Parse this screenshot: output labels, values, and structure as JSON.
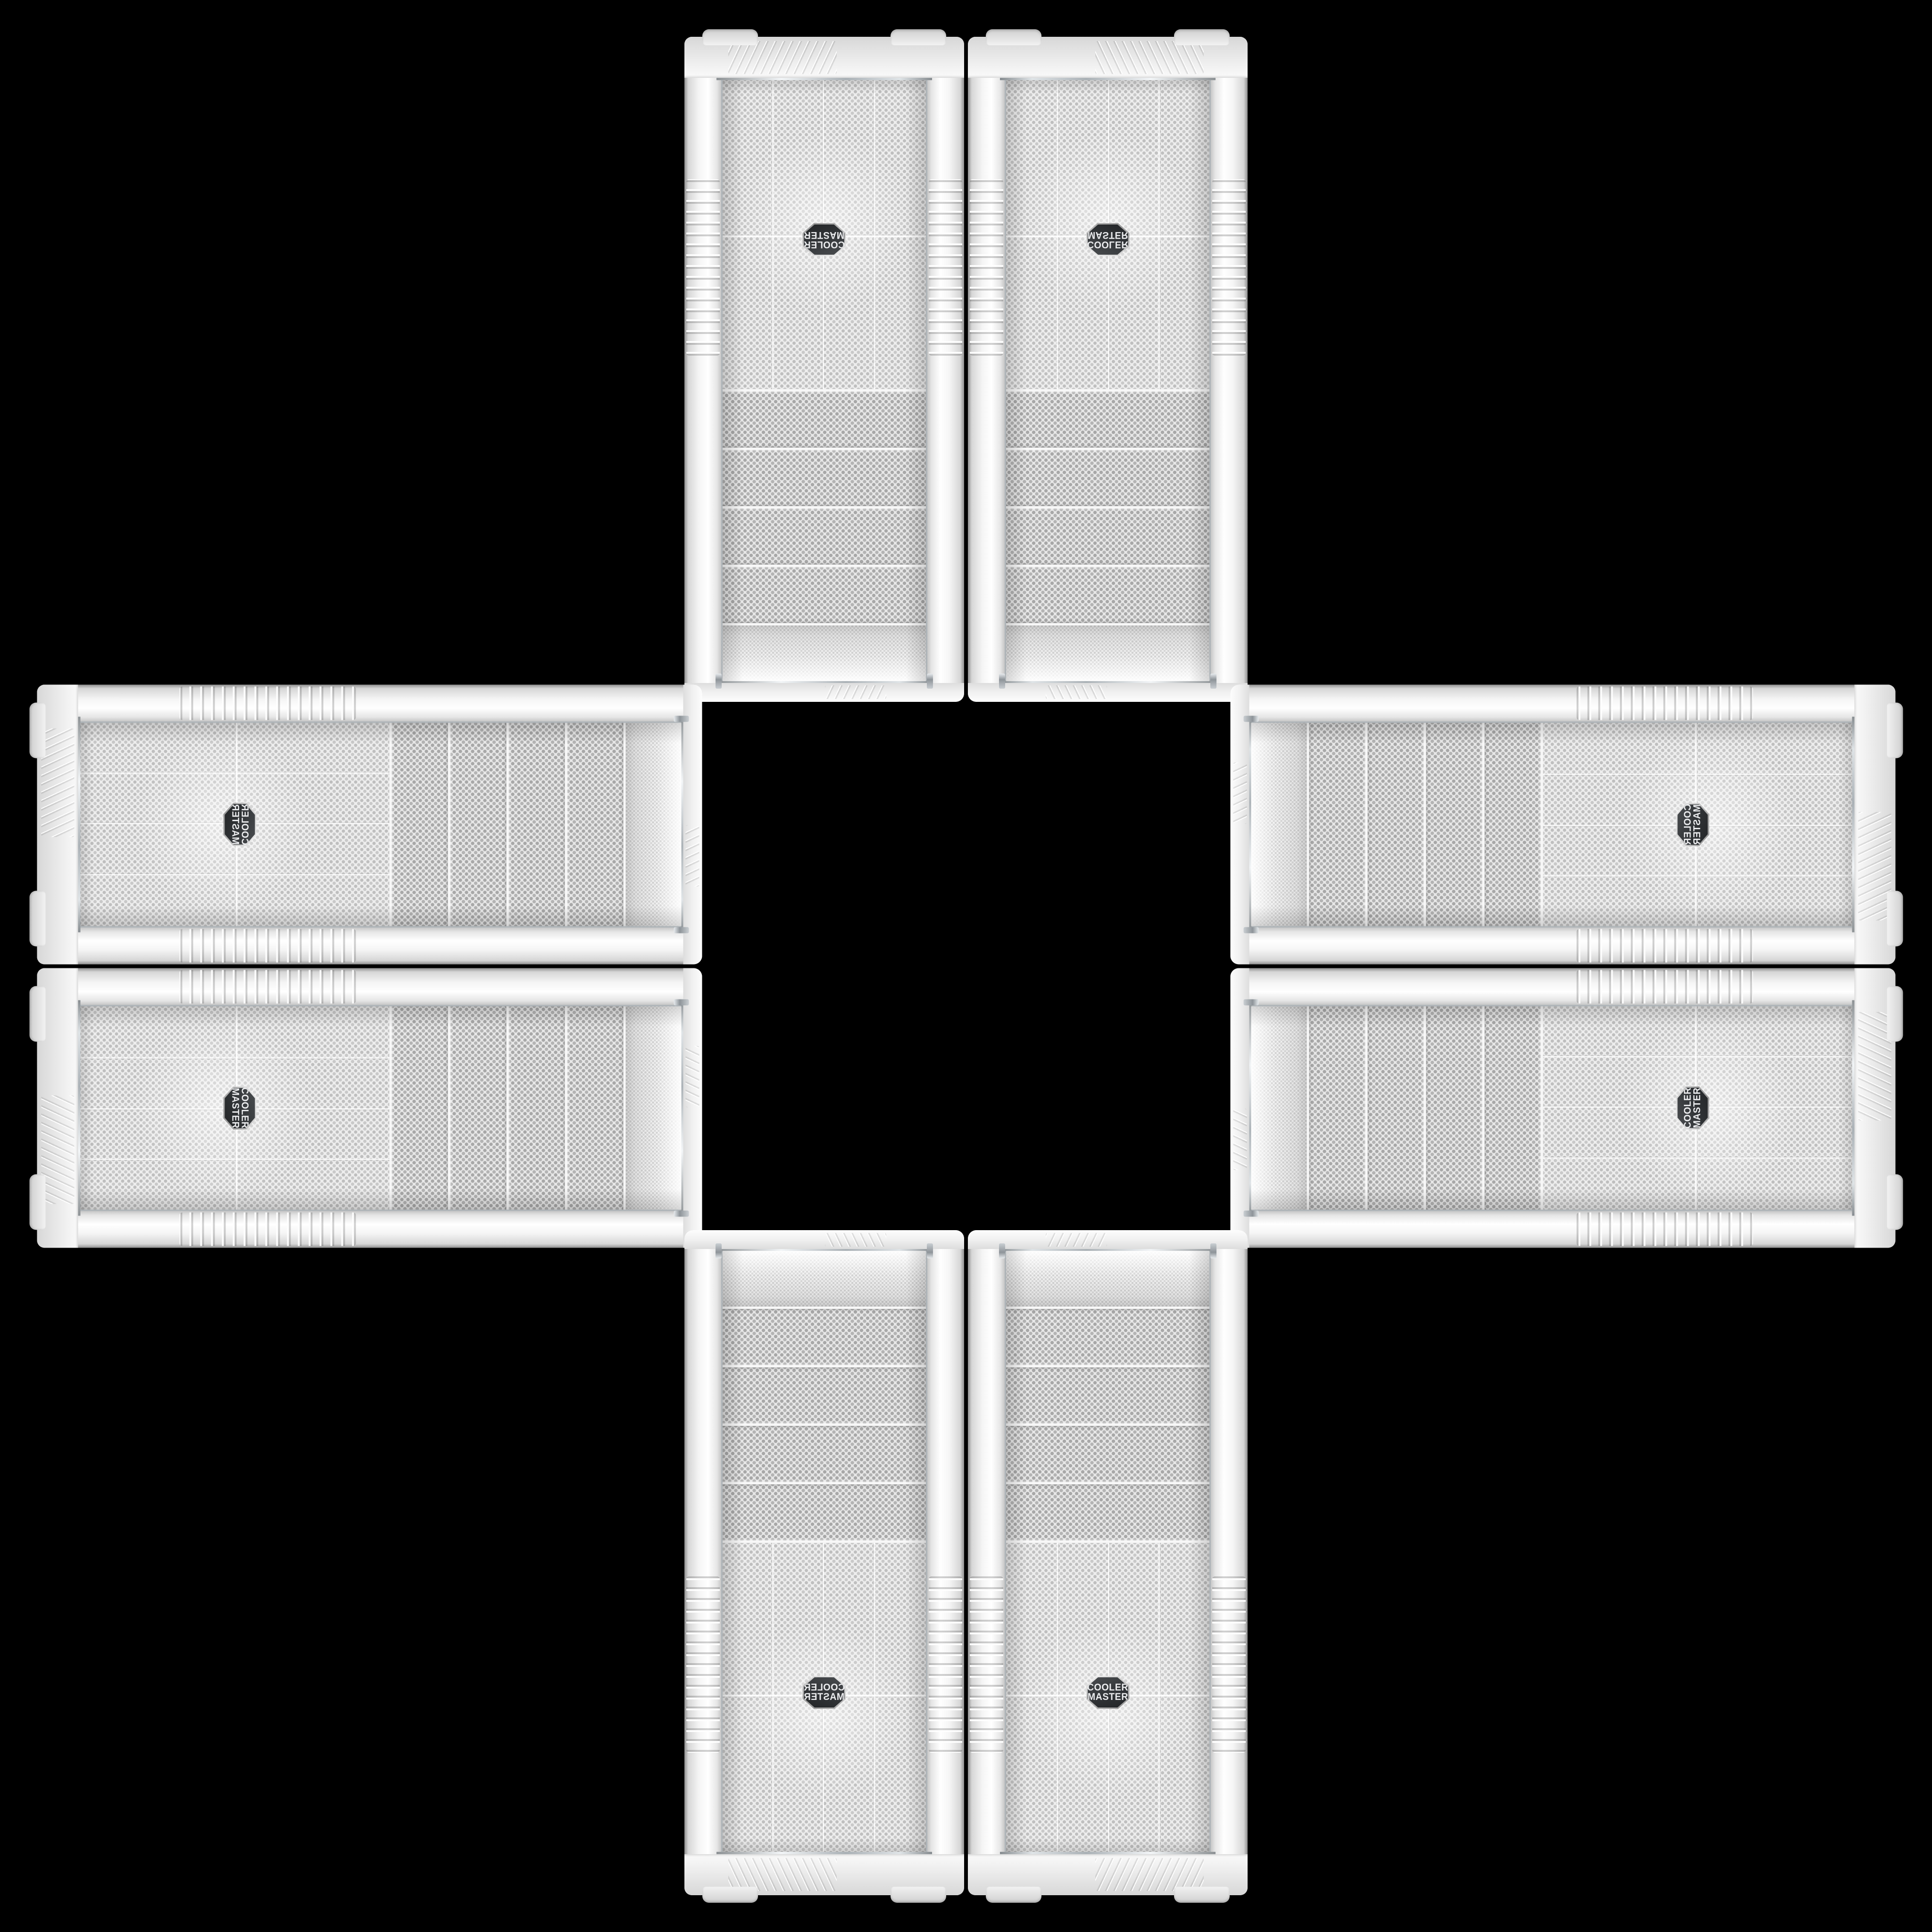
{
  "scene": {
    "description": "Eight identical white Cooler Master PC tower cases (front panel product shots) arranged in a cross / plus pattern on a black background; each copy is a rotated or mirrored duplicate of the same photo",
    "background_color": "#000000",
    "case_count": 8
  },
  "badge": {
    "line1": "COOLER",
    "line2": "MASTER",
    "shape": "hexagon-shield",
    "bg_color": "#313437",
    "text_color": "#ebecee"
  },
  "cases": [
    {
      "id": "top-left",
      "orientation": "rotated-180"
    },
    {
      "id": "top-right",
      "orientation": "flipped-vertical"
    },
    {
      "id": "left-top",
      "orientation": "rotated-90-mirrored"
    },
    {
      "id": "left-bottom",
      "orientation": "rotated-90-cw"
    },
    {
      "id": "right-top",
      "orientation": "rotated-90-transposed"
    },
    {
      "id": "right-bottom",
      "orientation": "rotated-90-ccw"
    },
    {
      "id": "bottom-left",
      "orientation": "flipped-horizontal"
    },
    {
      "id": "bottom-right",
      "orientation": "original-upright"
    }
  ],
  "case_features": {
    "drive_bay_covers": 4,
    "mesh_columns": 4,
    "feet_per_case": 2,
    "side_rails_ribbed": true
  },
  "colors": {
    "background": "#000000",
    "case_white": "#f1f1f1",
    "case_shadow": "#b9b9b9",
    "mesh_background": "#ededed",
    "mesh_dot": "#bfbfbf",
    "bay_dot": "#a8a8a8",
    "chrome_trim": "#aeb4b8",
    "badge_background": "#313437",
    "badge_text": "#ebecee"
  }
}
